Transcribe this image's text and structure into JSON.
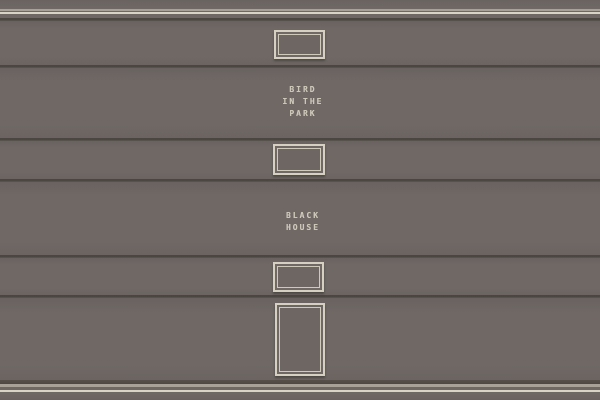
{
  "scene": {
    "description": "paneled wall with hanging picture frames and painting titles",
    "colors": {
      "wall": "#6e6764",
      "molding_light_gray": "#a8a198",
      "molding_cream": "#d9d3c6",
      "panel_seam_dark": "#4c4641",
      "frame_border": "#d6d0c3",
      "title_text": "#cdc7ba"
    },
    "titles": {
      "first": "BIRD\nIN THE\nPARK",
      "second": "BLACK\nHOUSE"
    },
    "frames": {
      "count": 4,
      "types": [
        "small-landscape",
        "small-landscape",
        "small-landscape",
        "tall-portrait"
      ]
    }
  }
}
